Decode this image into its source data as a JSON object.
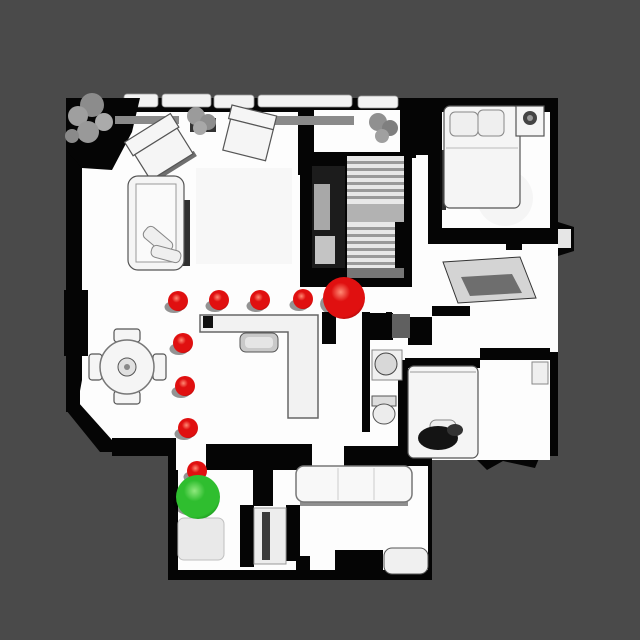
{
  "scene": {
    "description": "top-down view of 3D scanned house with navigation path",
    "background_color": "#4a4a4a",
    "floor_color": "#fdfdfd",
    "wall_color": "#050505",
    "viewport": {
      "width": 640,
      "height": 640
    }
  },
  "markers": {
    "waypoint_radius": 10,
    "shadow_opacity": 0.42,
    "colors": {
      "red": {
        "highlight": "#ff8a74",
        "base": "#e01010",
        "edge": "#8f0303"
      },
      "green": {
        "highlight": "#90e97e",
        "base": "#2fbe2f",
        "edge": "#0e7a11"
      }
    },
    "start": {
      "name": "start",
      "color_key": "green",
      "x": 198,
      "y": 497,
      "r": 22
    },
    "goal": {
      "name": "goal",
      "color_key": "red",
      "x": 344,
      "y": 298,
      "r": 21
    },
    "waypoints": [
      {
        "x": 197,
        "y": 471
      },
      {
        "x": 188,
        "y": 428
      },
      {
        "x": 185,
        "y": 386
      },
      {
        "x": 183,
        "y": 343
      },
      {
        "x": 178,
        "y": 301
      },
      {
        "x": 219,
        "y": 300
      },
      {
        "x": 260,
        "y": 300
      },
      {
        "x": 303,
        "y": 299
      }
    ]
  }
}
